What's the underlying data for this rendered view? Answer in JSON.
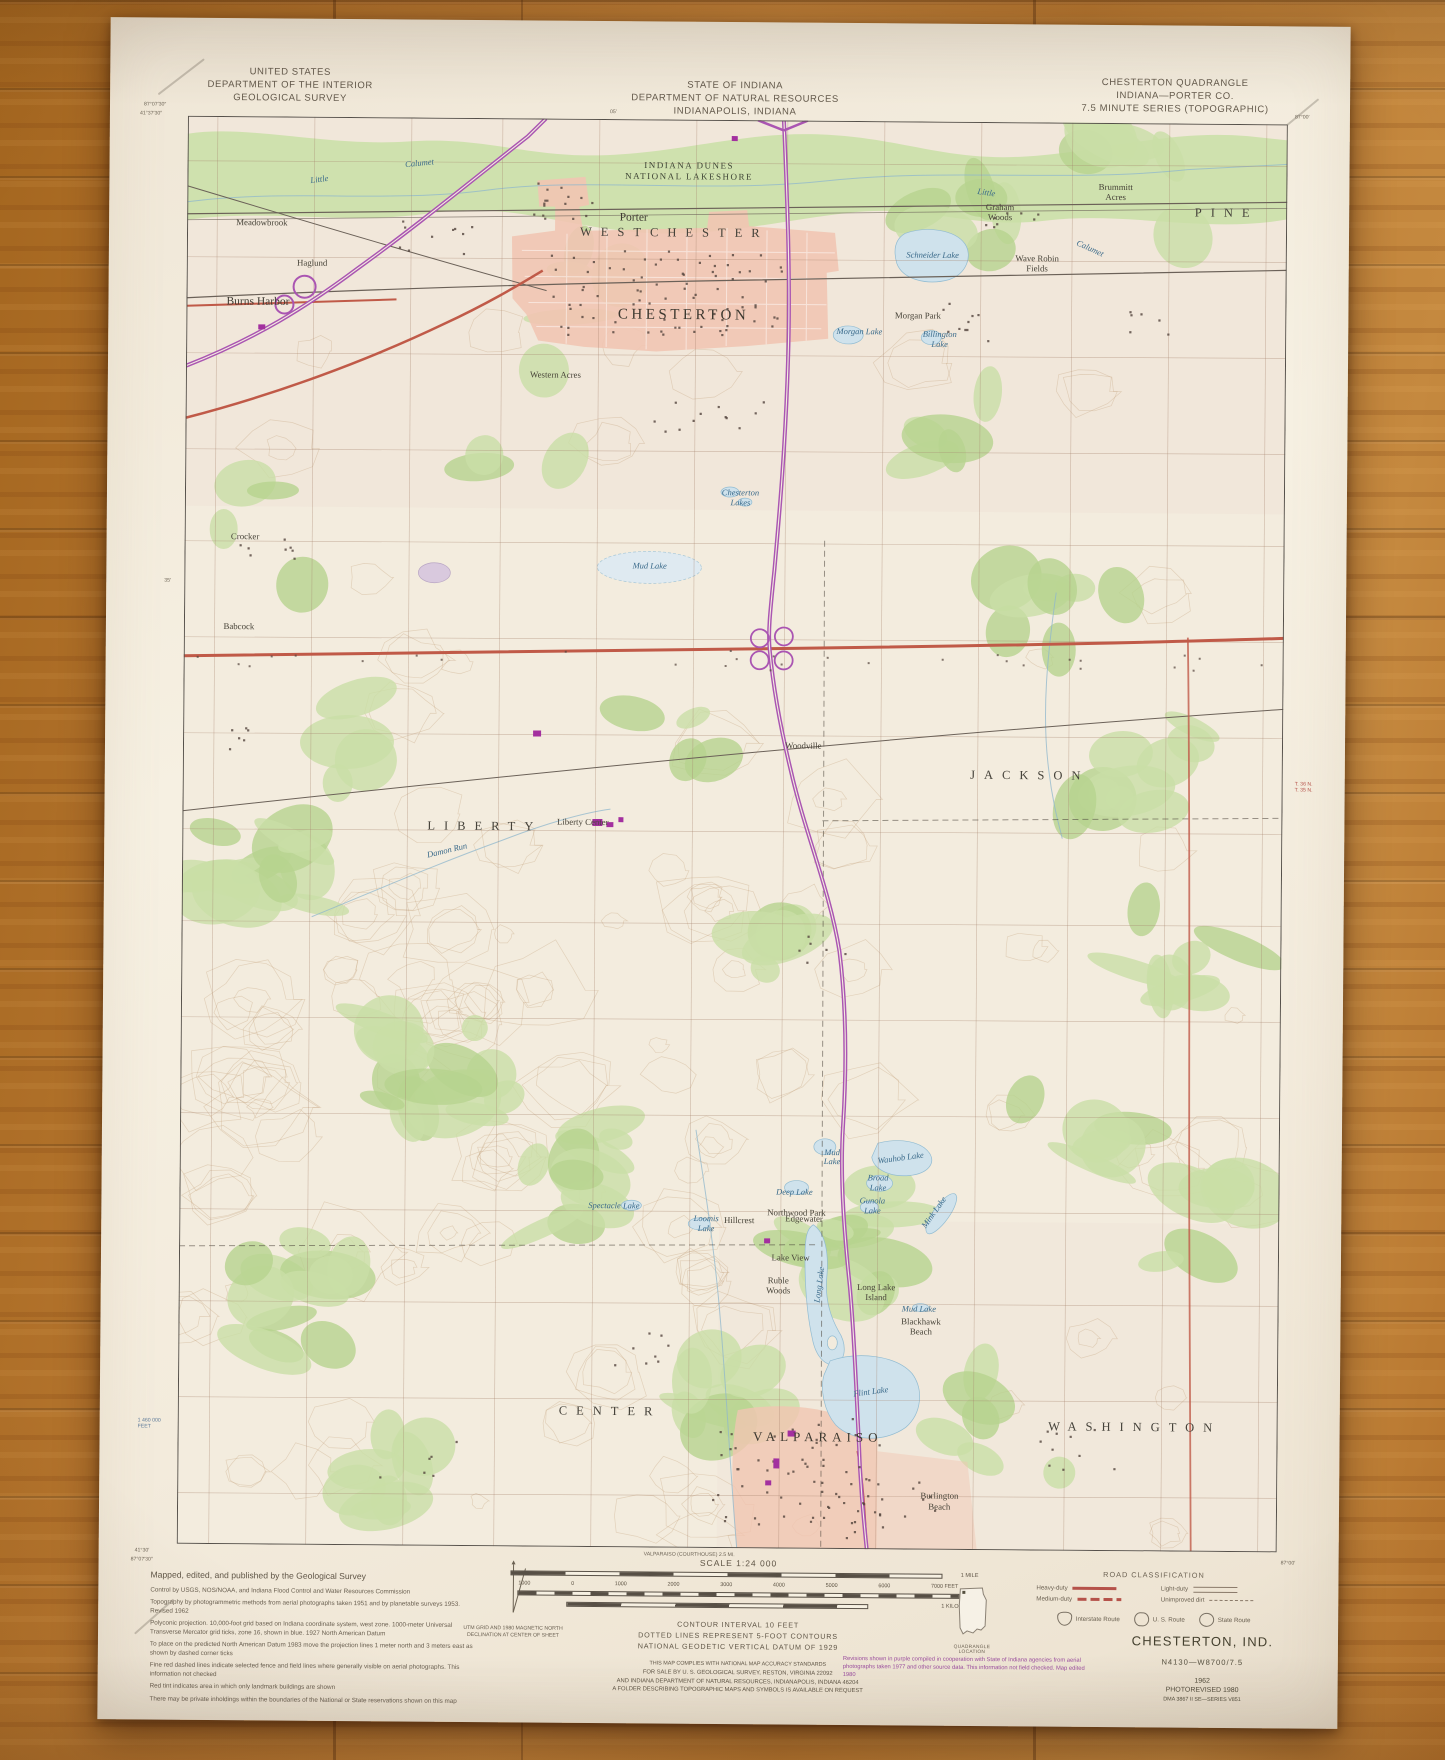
{
  "header": {
    "agency": "UNITED STATES\nDEPARTMENT OF THE INTERIOR\nGEOLOGICAL SURVEY",
    "state": "STATE OF INDIANA\nDEPARTMENT OF NATURAL RESOURCES\nINDIANAPOLIS, INDIANA",
    "quad": "CHESTERTON QUADRANGLE\nINDIANA—PORTER CO.\n7.5 MINUTE SERIES (TOPOGRAPHIC)"
  },
  "margins": {
    "tl_lon": "87°07′30″",
    "tl_lat": "41°37′30″",
    "tr_lon": "87°00′",
    "bl_lat": "41°30′",
    "bl_lon": "87°07′30″",
    "br_lon": "87°00′",
    "left_min": "35′",
    "top_min": "05′",
    "feet_label": "1 460 000\nFEET",
    "twp": "T. 36 N.\nT. 35 N.",
    "bottom_note": "VALPARAISO (COURTHOUSE) 2.5 MI."
  },
  "map": {
    "labels": [
      {
        "t": "WESTCHESTER",
        "x": 44.3,
        "y": 7.9,
        "c": "twp"
      },
      {
        "t": "PINE",
        "x": 94.5,
        "y": 6.2,
        "c": "twp"
      },
      {
        "t": "JACKSON",
        "x": 77.0,
        "y": 45.7,
        "c": "twp"
      },
      {
        "t": "LIBERTY",
        "x": 27.5,
        "y": 49.6,
        "c": "twp"
      },
      {
        "t": "CENTER",
        "x": 39.3,
        "y": 90.5,
        "c": "twp"
      },
      {
        "t": "WASHINGTON",
        "x": 87.0,
        "y": 91.3,
        "c": "twp"
      },
      {
        "t": "CHESTERTON",
        "x": 45.2,
        "y": 13.7,
        "c": "city"
      },
      {
        "t": "VALPARAISO",
        "x": 58.2,
        "y": 92.2,
        "c": "city2"
      },
      {
        "t": "Porter",
        "x": 40.6,
        "y": 6.9,
        "c": "town"
      },
      {
        "t": "Burns Harbor",
        "x": 6.5,
        "y": 13.0,
        "c": "town"
      },
      {
        "t": "Meadowbrook",
        "x": 6.8,
        "y": 7.4,
        "c": "place"
      },
      {
        "t": "Haglund",
        "x": 11.4,
        "y": 10.2,
        "c": "place"
      },
      {
        "t": "Morgan Park",
        "x": 66.5,
        "y": 13.6,
        "c": "place"
      },
      {
        "t": "Graham\nWoods",
        "x": 73.9,
        "y": 6.3,
        "c": "place"
      },
      {
        "t": "Brummitt\nAcres",
        "x": 84.4,
        "y": 4.8,
        "c": "place"
      },
      {
        "t": "Wave Robin\nFields",
        "x": 77.3,
        "y": 9.9,
        "c": "place"
      },
      {
        "t": "Western Acres",
        "x": 33.6,
        "y": 17.9,
        "c": "place"
      },
      {
        "t": "Crocker",
        "x": 5.5,
        "y": 29.4,
        "c": "place"
      },
      {
        "t": "Babcock",
        "x": 5.0,
        "y": 35.7,
        "c": "place"
      },
      {
        "t": "Woodville",
        "x": 56.4,
        "y": 43.8,
        "c": "place"
      },
      {
        "t": "Liberty Center",
        "x": 36.4,
        "y": 49.2,
        "c": "place"
      },
      {
        "t": "Northwood Park",
        "x": 56.1,
        "y": 76.5,
        "c": "place"
      },
      {
        "t": "Lake View",
        "x": 55.6,
        "y": 79.6,
        "c": "place"
      },
      {
        "t": "Ruble\nWoods",
        "x": 54.5,
        "y": 81.6,
        "c": "place"
      },
      {
        "t": "Long Lake\nIsland",
        "x": 63.4,
        "y": 82.0,
        "c": "place"
      },
      {
        "t": "Blackhawk\nBeach",
        "x": 67.5,
        "y": 84.4,
        "c": "place"
      },
      {
        "t": "Hillcrest",
        "x": 50.9,
        "y": 77.0,
        "c": "place"
      },
      {
        "t": "Edgewater",
        "x": 56.8,
        "y": 76.9,
        "c": "place"
      },
      {
        "t": "Burlington\nBeach",
        "x": 69.3,
        "y": 96.6,
        "c": "place"
      },
      {
        "t": "INDIANA DUNES\nNATIONAL LAKESHORE",
        "x": 45.6,
        "y": 3.6,
        "c": "park"
      },
      {
        "t": "Little",
        "x": 12.0,
        "y": 4.4,
        "c": "water",
        "r": -8
      },
      {
        "t": "Calumet",
        "x": 21.1,
        "y": 3.2,
        "c": "water",
        "r": -6
      },
      {
        "t": "Little",
        "x": 72.6,
        "y": 5.0,
        "c": "water",
        "r": 8
      },
      {
        "t": "Calumet",
        "x": 82.1,
        "y": 8.8,
        "c": "water",
        "r": 24
      },
      {
        "t": "Schneider Lake",
        "x": 67.8,
        "y": 9.4,
        "c": "water"
      },
      {
        "t": "Morgan Lake",
        "x": 61.2,
        "y": 14.8,
        "c": "water"
      },
      {
        "t": "Billington\nLake",
        "x": 68.5,
        "y": 15.3,
        "c": "water"
      },
      {
        "t": "Chesterton\nLakes",
        "x": 50.5,
        "y": 26.5,
        "c": "water"
      },
      {
        "t": "Mud Lake",
        "x": 42.3,
        "y": 31.3,
        "c": "water"
      },
      {
        "t": "Damon Run",
        "x": 24.1,
        "y": 51.3,
        "c": "water",
        "r": -14
      },
      {
        "t": "Mud\nLake",
        "x": 59.3,
        "y": 72.6,
        "c": "water"
      },
      {
        "t": "Wauhob Lake",
        "x": 65.5,
        "y": 72.6,
        "c": "water",
        "r": -8
      },
      {
        "t": "Broad\nLake",
        "x": 63.5,
        "y": 74.4,
        "c": "water"
      },
      {
        "t": "Deep Lake",
        "x": 55.9,
        "y": 75.1,
        "c": "water"
      },
      {
        "t": "Gunola\nLake",
        "x": 63.0,
        "y": 76.0,
        "c": "water"
      },
      {
        "t": "Mink Lake",
        "x": 68.6,
        "y": 76.4,
        "c": "water",
        "r": -55
      },
      {
        "t": "Long Lake",
        "x": 58.3,
        "y": 81.5,
        "c": "water",
        "r": -83
      },
      {
        "t": "Spectacle Lake",
        "x": 39.5,
        "y": 76.1,
        "c": "water"
      },
      {
        "t": "Loomis\nLake",
        "x": 47.9,
        "y": 77.3,
        "c": "water"
      },
      {
        "t": "Mud Lake",
        "x": 67.3,
        "y": 83.2,
        "c": "water"
      },
      {
        "t": "Flint Lake",
        "x": 63.0,
        "y": 89.0,
        "c": "water",
        "r": -8
      }
    ]
  },
  "footer": {
    "credits_title": "Mapped, edited, and published by the Geological Survey",
    "credits": [
      "Control by USGS, NOS/NOAA, and Indiana Flood Control and Water Resources Commission",
      "Topography by photogrammetric methods from aerial photographs taken 1951 and by planetable surveys 1953.  Revised 1962",
      "Polyconic projection.  10,000-foot grid based on Indiana coordinate system, west zone.  1000-meter Universal Transverse Mercator grid ticks, zone 16, shown in blue.  1927 North American Datum",
      "To place on the predicted North American Datum 1983 move the projection lines 1 meter north and 3 meters east as shown by dashed corner ticks",
      "Fine red dashed lines indicate selected fence and field lines where generally visible on aerial photographs.  This information not checked",
      "Red tint indicates area in which only landmark buildings are shown",
      "There may be private inholdings within the boundaries of the National or State reservations shown on this map"
    ],
    "scale": {
      "label": "SCALE 1:24 000",
      "mile": "1 MILE",
      "feet_ticks": [
        "1000",
        "0",
        "1000",
        "2000",
        "3000",
        "4000",
        "5000",
        "6000",
        "7000 FEET"
      ],
      "km": "1 KILOMETER"
    },
    "contour": "CONTOUR INTERVAL 10 FEET\nDOTTED LINES REPRESENT 5-FOOT CONTOURS\nNATIONAL GEODETIC VERTICAL DATUM OF 1929",
    "accuracy": "THIS MAP COMPLIES WITH NATIONAL MAP ACCURACY STANDARDS",
    "sale": "FOR SALE BY U. S. GEOLOGICAL SURVEY, RESTON, VIRGINIA 22092\nAND INDIANA DEPARTMENT OF NATURAL RESOURCES, INDIANAPOLIS, INDIANA 46204\nA FOLDER DESCRIBING TOPOGRAPHIC MAPS AND SYMBOLS IS AVAILABLE ON REQUEST",
    "road_class": {
      "title": "ROAD CLASSIFICATION",
      "entries": [
        {
          "label": "Heavy-duty",
          "style": "heavy"
        },
        {
          "label": "Light-duty",
          "style": "light"
        },
        {
          "label": "Medium-duty",
          "style": "medium"
        },
        {
          "label": "Unimproved dirt",
          "style": "dirt"
        }
      ],
      "badges": [
        "Interstate Route",
        "U. S. Route",
        "State Route"
      ]
    },
    "name_block": {
      "name": "CHESTERTON, IND.",
      "code": "N4130—W8700/7.5",
      "year": "1962",
      "photorev": "PHOTOREVISED 1980",
      "series": "DMA 3867 II SE—SERIES V851"
    },
    "revision_note": "Revisions shown in purple compiled in cooperation with State of Indiana agencies from aerial photographs taken 1977 and other source data.  This information not field checked.  Map edited 1980",
    "quad_location": "QUADRANGLE LOCATION",
    "magnetic": "UTM GRID AND 1980 MAGNETIC NORTH\nDECLINATION AT CENTER OF SHEET"
  }
}
